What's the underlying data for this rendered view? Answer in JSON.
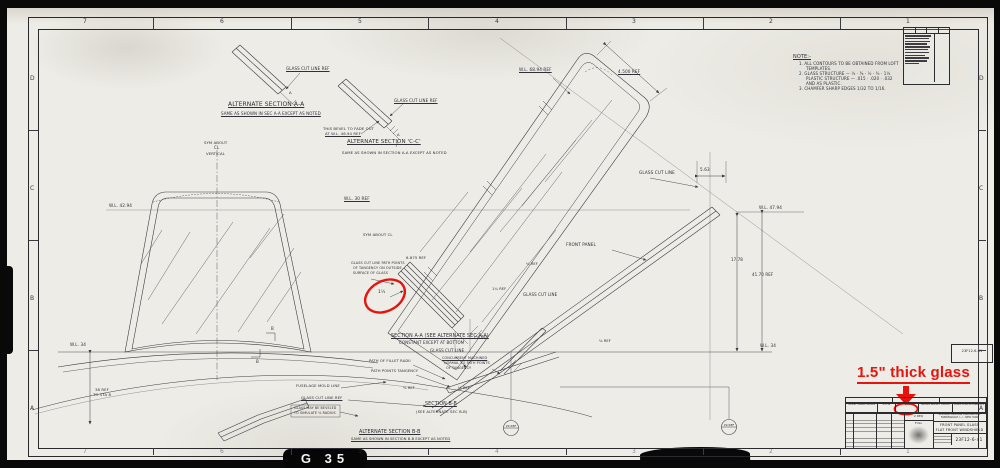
{
  "annotation": {
    "label": "1.5\" thick glass",
    "color": "#e8130c"
  },
  "sheet_tag": {
    "label": "G 35"
  },
  "balloons": {
    "b1": "29 REF",
    "b2": "29 REF"
  },
  "zones": {
    "top": [
      "7",
      "6",
      "5",
      "4",
      "3",
      "2",
      "1"
    ],
    "bottom": [
      "7",
      "6",
      "5",
      "4",
      "3",
      "2",
      "1"
    ],
    "left": [
      "D",
      "C",
      "B",
      "A"
    ],
    "right": [
      "D",
      "C",
      "B",
      "A"
    ]
  },
  "title_block": {
    "company_1": "REPUBLIC AVIATION CORPORATION",
    "company_2": "FARMINGDALE, L. I., NEW YORK",
    "title_1": "FRONT PANEL GLASS",
    "title_2": "FLAT FRONT WINDSHIELD",
    "drawing_number": "23F12-6-41",
    "qty": "2 REQ",
    "scale": "FULL",
    "margin_tag": "23F12-6-41",
    "strip_cells": [
      "FRONT PANEL GLASS",
      "23F12",
      "1.50",
      "GLASS BULLET PROOF",
      "LONG DIMEN PARALLEL"
    ]
  },
  "labels": [
    {
      "n": "note-title",
      "t": "NOTE:-",
      "x": 793,
      "y": 55,
      "s": 5,
      "u": true
    },
    {
      "n": "note-line-1",
      "t": "1. ALL CONTOURS TO BE OBTAINED FROM LOFT",
      "x": 799,
      "y": 62,
      "s": 4
    },
    {
      "n": "note-line-1b",
      "t": "TEMPLATES.",
      "x": 806,
      "y": 67,
      "s": 4
    },
    {
      "n": "note-line-2",
      "t": "2. GLASS STRUCTURE — ¼ · ⅜ · ½ · ¾ · 1¼",
      "x": 799,
      "y": 72,
      "s": 4
    },
    {
      "n": "note-line-2b",
      "t": "PLASTIC STRUCTURE — .015 · .020 · .032",
      "x": 806,
      "y": 77,
      "s": 4
    },
    {
      "n": "note-line-2c",
      "t": "AND AS PLASTIC.",
      "x": 806,
      "y": 82,
      "s": 4
    },
    {
      "n": "note-line-3",
      "t": "3. CHAMFER SHARP EDGES 1/32 TO 1/16.",
      "x": 799,
      "y": 87,
      "s": 4
    },
    {
      "n": "label-glass-cut-ref-1",
      "t": "GLASS CUT LINE REF",
      "x": 286,
      "y": 67,
      "s": 4,
      "u": true
    },
    {
      "n": "label-alt-section-aa",
      "t": "ALTERNATE  SECTION A-A",
      "x": 228,
      "y": 102,
      "s": 6,
      "u": true
    },
    {
      "n": "label-alt-section-aa-sub",
      "t": "SAME AS SHOWN IN SEC A-A EXCEPT AS NOTED",
      "x": 221,
      "y": 112,
      "s": 4,
      "u": true
    },
    {
      "n": "label-glass-cut-ref-2",
      "t": "GLASS CUT LINE REF",
      "x": 394,
      "y": 99,
      "s": 4,
      "u": true
    },
    {
      "n": "label-bevel-note-1",
      "t": "THIS BEVEL TO FADE OUT",
      "x": 323,
      "y": 127,
      "s": 3.8
    },
    {
      "n": "label-bevel-note-2",
      "t": "AT  W.L. 46.94  REF",
      "x": 325,
      "y": 132,
      "s": 3.8,
      "u": true
    },
    {
      "n": "label-alt-section-cc",
      "t": "ALTERNATE SECTION 'C-C'",
      "x": 347,
      "y": 140,
      "s": 5.5,
      "u": true
    },
    {
      "n": "label-alt-section-cc-sub",
      "t": "SAME AS SHOWN IN SECTION A-A EXCEPT AS NOTED",
      "x": 342,
      "y": 151,
      "s": 3.8
    },
    {
      "n": "label-sym-about-1",
      "t": "SYM ABOUT",
      "x": 204,
      "y": 141,
      "s": 3.8
    },
    {
      "n": "label-sym-about-1b",
      "t": "CL",
      "x": 214,
      "y": 146,
      "s": 4
    },
    {
      "n": "label-sym-about-1c",
      "t": "VERTICAL",
      "x": 206,
      "y": 152,
      "s": 3.8
    },
    {
      "n": "label-wl-4294",
      "t": "W.L. 42.94",
      "x": 109,
      "y": 204,
      "s": 4.2
    },
    {
      "n": "label-wl-6894",
      "t": "W.L. 68.94 REF",
      "x": 519,
      "y": 68,
      "s": 4.2,
      "u": true
    },
    {
      "n": "label-dim-4500",
      "t": "4.500 REF",
      "x": 618,
      "y": 70,
      "s": 4.2,
      "u": true
    },
    {
      "n": "label-wl-30",
      "t": "W.L. 30 REF",
      "x": 344,
      "y": 197,
      "s": 4.2,
      "u": true
    },
    {
      "n": "label-sym-about-2",
      "t": "SYM ABOUT CL",
      "x": 363,
      "y": 233,
      "s": 3.8
    },
    {
      "n": "label-dim-6875",
      "t": "6.875 REF",
      "x": 406,
      "y": 256,
      "s": 3.8
    },
    {
      "n": "label-glass-cut-note-1",
      "t": "GLASS CUT LINE PATH POINTS",
      "x": 351,
      "y": 262,
      "s": 3.4
    },
    {
      "n": "label-glass-cut-note-2",
      "t": "OF TANGENCY ON OUTSIDE",
      "x": 353,
      "y": 267,
      "s": 3.4
    },
    {
      "n": "label-glass-cut-note-3",
      "t": "SURFACE OF GLASS",
      "x": 353,
      "y": 272,
      "s": 3.4
    },
    {
      "n": "label-dim-thickness",
      "t": "1½",
      "x": 378,
      "y": 291,
      "s": 4.5
    },
    {
      "n": "label-front-panel",
      "t": "FRONT PANEL",
      "x": 566,
      "y": 243,
      "s": 4.2
    },
    {
      "n": "label-glass-cut-line-3",
      "t": "GLASS CUT LINE",
      "x": 523,
      "y": 293,
      "s": 4
    },
    {
      "n": "label-glass-cut-line-4",
      "t": "GLASS CUT LINE",
      "x": 639,
      "y": 171,
      "s": 4.2
    },
    {
      "n": "label-dim-563",
      "t": "5.63",
      "x": 700,
      "y": 168,
      "s": 4.2
    },
    {
      "n": "label-wl-4794",
      "t": "W.L. 47.94",
      "x": 759,
      "y": 206,
      "s": 4.2
    },
    {
      "n": "label-dim-1778",
      "t": "17.78",
      "x": 731,
      "y": 258,
      "s": 4
    },
    {
      "n": "label-dim-4170",
      "t": "41.70 REF",
      "x": 752,
      "y": 273,
      "s": 4
    },
    {
      "n": "label-wl-34-right",
      "t": "W.L. 34",
      "x": 760,
      "y": 344,
      "s": 4.2
    },
    {
      "n": "label-section-aa",
      "t": "SECTION A-A (SEE ALTERNATE SEC A-A)",
      "x": 391,
      "y": 334,
      "s": 4.8,
      "u": true
    },
    {
      "n": "label-section-aa-sub",
      "t": "CONSTANT EXCEPT AT BOTTOM",
      "x": 399,
      "y": 341,
      "s": 4
    },
    {
      "n": "label-dim-eighth-1",
      "t": "⅛ REF",
      "x": 526,
      "y": 263,
      "s": 3.6
    },
    {
      "n": "label-dim-114",
      "t": "1¼ REF",
      "x": 492,
      "y": 288,
      "s": 3.6
    },
    {
      "n": "label-dim-eighth-2",
      "t": "⅛ REF",
      "x": 476,
      "y": 336,
      "s": 3.6
    },
    {
      "n": "label-glass-cut-line-5",
      "t": "GLASS CUT LINE",
      "x": 430,
      "y": 349,
      "s": 4
    },
    {
      "n": "label-concurrent-1",
      "t": "CONCURRENT MACHINED",
      "x": 442,
      "y": 357,
      "s": 3.4,
      "u": true
    },
    {
      "n": "label-concurrent-2",
      "t": "NORMAL TO PATH POINTS",
      "x": 444,
      "y": 362,
      "s": 3.4
    },
    {
      "n": "label-concurrent-3",
      "t": "OF TANGENCY",
      "x": 446,
      "y": 367,
      "s": 3.4
    },
    {
      "n": "label-path-fillet",
      "t": "PATH OF FILLET RADII",
      "x": 369,
      "y": 360,
      "s": 3.7
    },
    {
      "n": "label-path-tangency",
      "t": "PATH POINTS TANGENCY",
      "x": 371,
      "y": 370,
      "s": 3.7
    },
    {
      "n": "label-fuselage-mold",
      "t": "FUSELAGE  MOLD  LINE",
      "x": 296,
      "y": 384,
      "s": 3.8
    },
    {
      "n": "label-glass-cut-ref-b",
      "t": "GLASS CUT LINE REF",
      "x": 301,
      "y": 396,
      "s": 3.8,
      "u": true
    },
    {
      "n": "label-bevel-box-1",
      "t": "GLASS MAY BE BEVELED",
      "x": 294,
      "y": 407,
      "s": 3.3
    },
    {
      "n": "label-bevel-box-2",
      "t": "TO SIMULATE ⅛ RADIUS",
      "x": 294,
      "y": 412,
      "s": 3.3
    },
    {
      "n": "label-dim-eighth-3",
      "t": "⅛ REF",
      "x": 403,
      "y": 387,
      "s": 3.6
    },
    {
      "n": "label-dim-eighth-4",
      "t": "⅛ REF",
      "x": 458,
      "y": 387,
      "s": 3.6
    },
    {
      "n": "label-dim-eighth-5",
      "t": "⅛ REF",
      "x": 599,
      "y": 340,
      "s": 3.6
    },
    {
      "n": "label-section-bb",
      "t": "SECTION B-B",
      "x": 425,
      "y": 402,
      "s": 4.8,
      "u": true
    },
    {
      "n": "label-section-bb-sub",
      "t": "(SEE ALTERNATE SEC B-B)",
      "x": 416,
      "y": 410,
      "s": 3.8
    },
    {
      "n": "label-alt-section-bb",
      "t": "ALTERNATE  SECTION B-B",
      "x": 359,
      "y": 430,
      "s": 4.8,
      "u": true
    },
    {
      "n": "label-alt-section-bb-sub",
      "t": "SAME AS SHOWN IN SECTION B-B EXCEPT AS NOTED",
      "x": 351,
      "y": 438,
      "s": 3.6,
      "u": true
    },
    {
      "n": "label-wl-34-left",
      "t": "W.L. 34",
      "x": 70,
      "y": 343,
      "s": 4.2
    },
    {
      "n": "label-ref-38",
      "t": "38 REF",
      "x": 95,
      "y": 388,
      "s": 3.8
    },
    {
      "n": "label-ref-38b",
      "t": "TO STA 8",
      "x": 93,
      "y": 393,
      "s": 3.8
    },
    {
      "n": "label-cut-b-1",
      "t": "B",
      "x": 271,
      "y": 327,
      "s": 4
    },
    {
      "n": "label-cut-b-2",
      "t": "B",
      "x": 256,
      "y": 360,
      "s": 4
    },
    {
      "n": "label-cut-a-1",
      "t": "A",
      "x": 289,
      "y": 91,
      "s": 3.8
    },
    {
      "n": "label-cut-a-2",
      "t": "A",
      "x": 397,
      "y": 133,
      "s": 3.8
    }
  ]
}
